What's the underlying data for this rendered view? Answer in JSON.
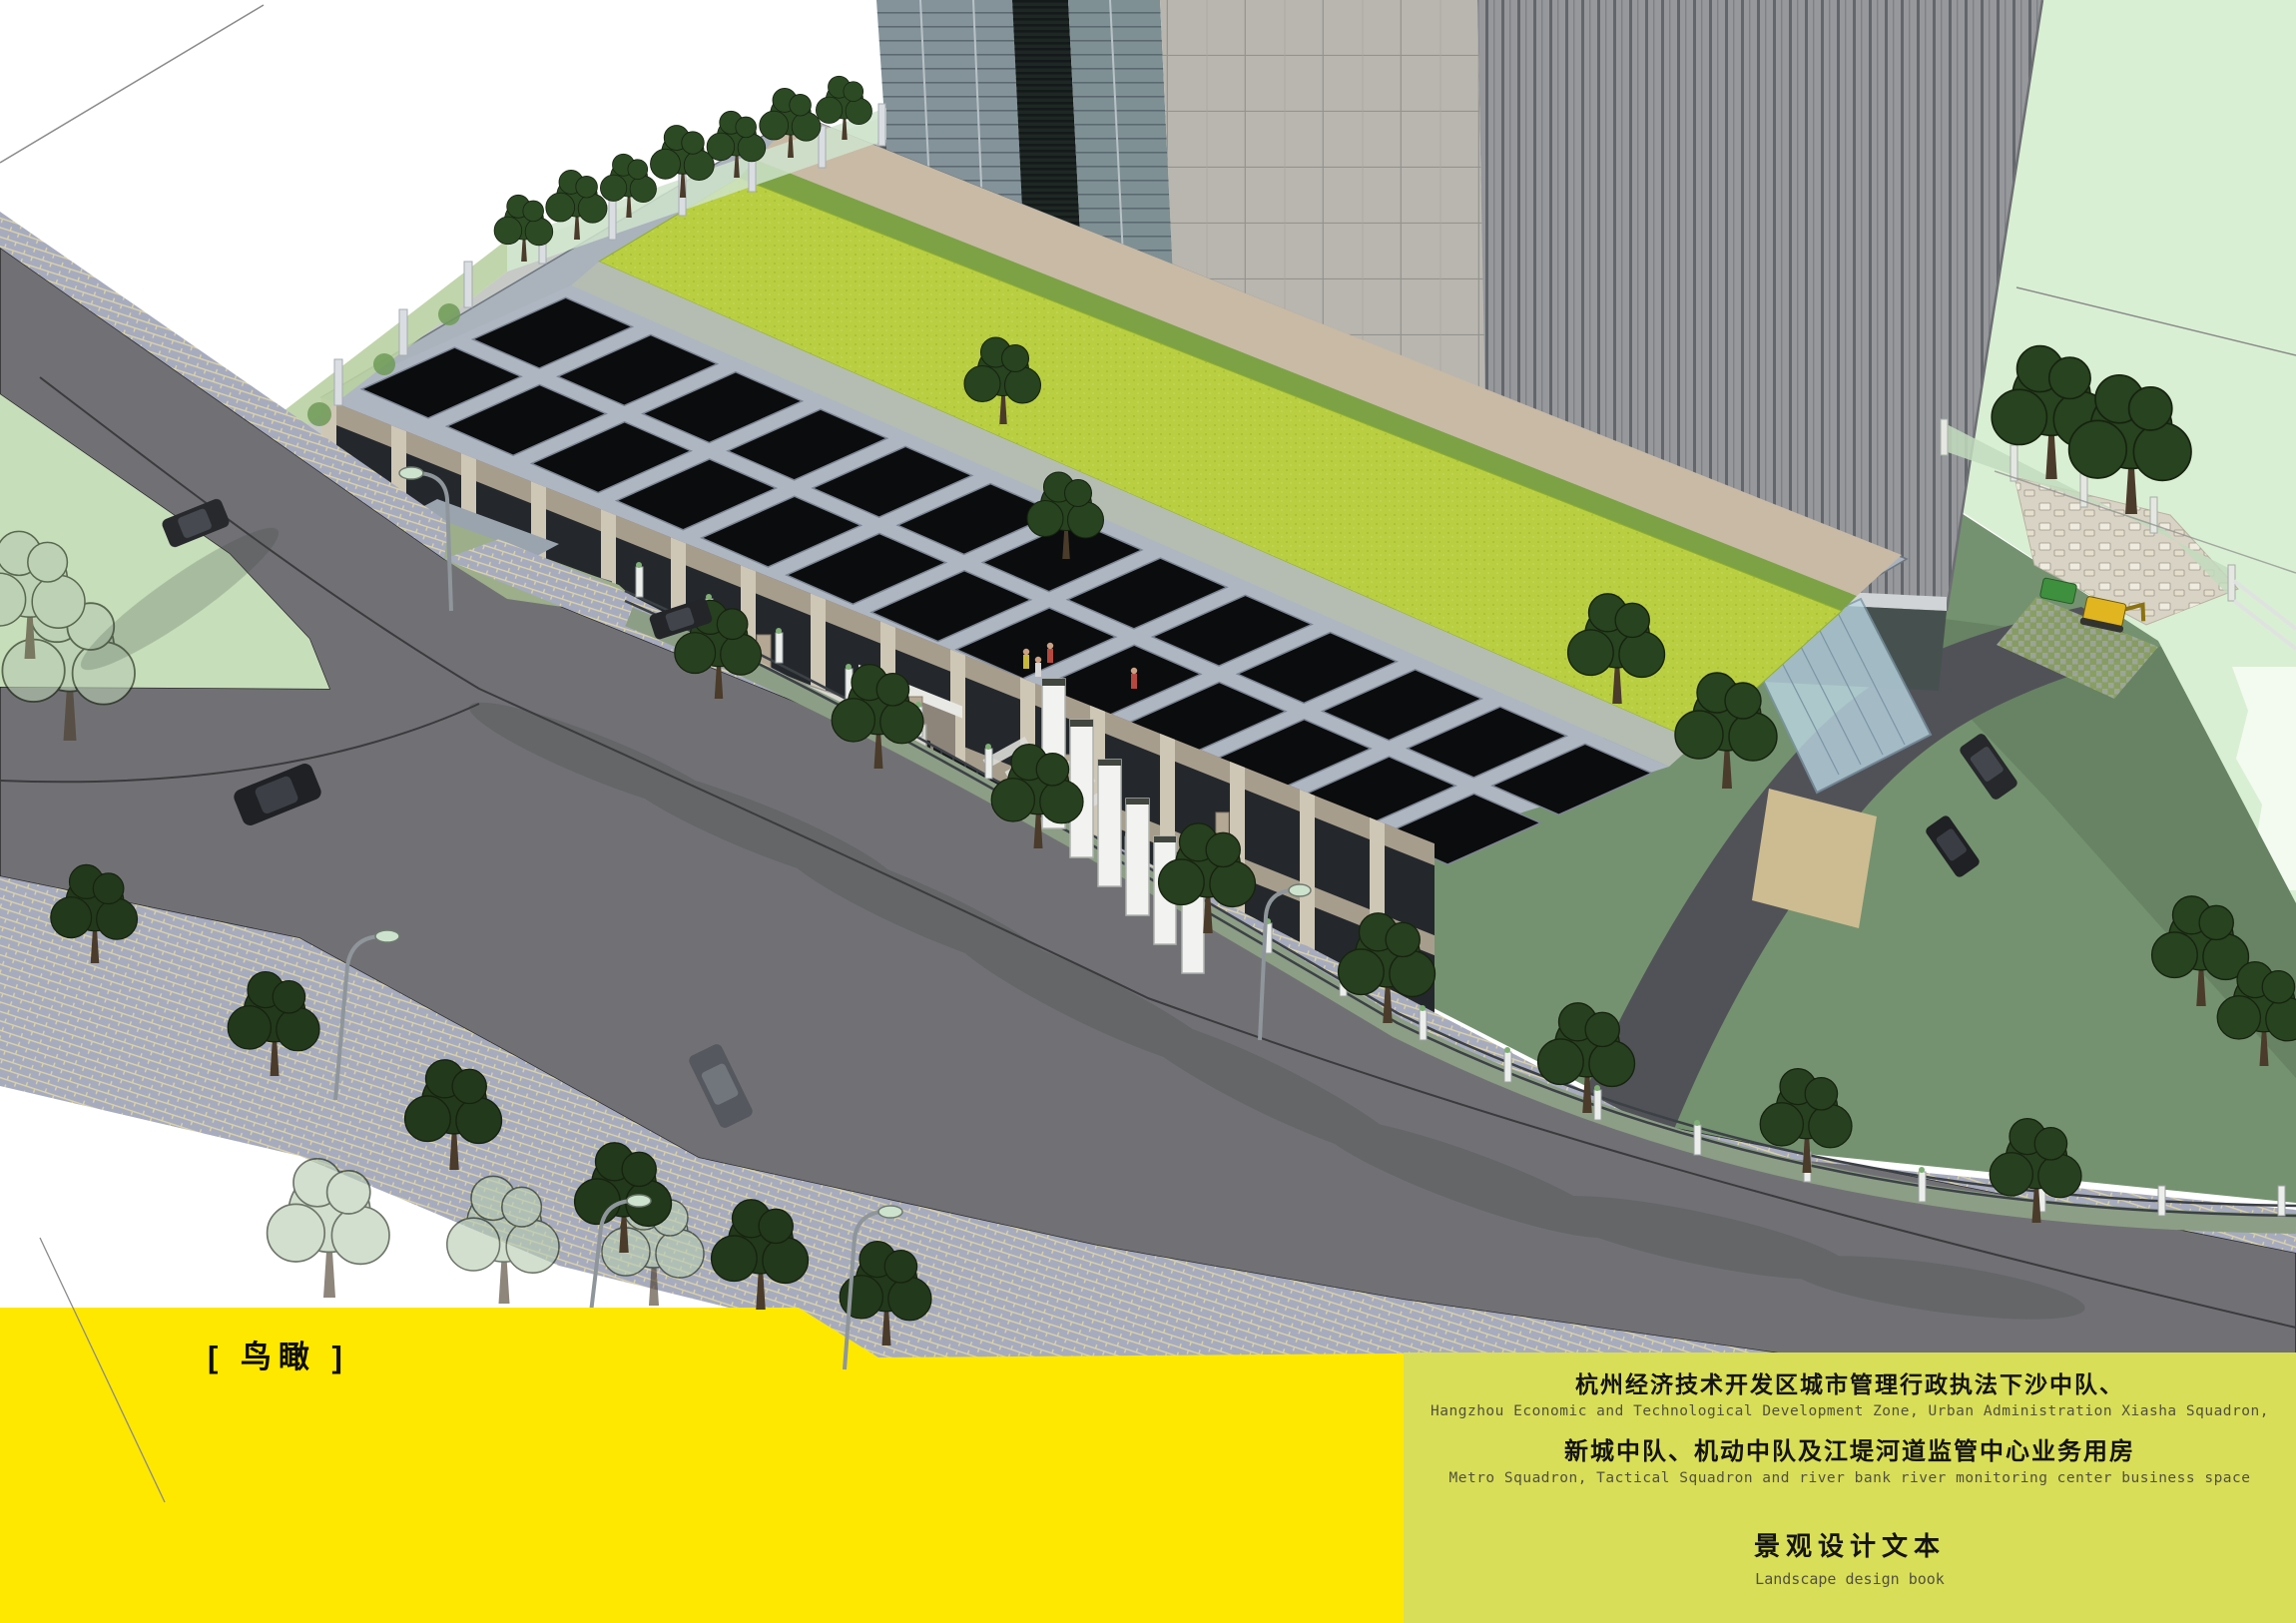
{
  "page_label": {
    "text": "[ 鸟瞰 ]"
  },
  "title_block": {
    "cn_line1": "杭州经济技术开发区城市管理行政执法下沙中队、",
    "en_line1": "Hangzhou Economic and Technological Development Zone, Urban Administration Xiasha Squadron,",
    "cn_line2": "新城中队、机动中队及江堤河道监管中心业务用房",
    "en_line2": "Metro Squadron, Tactical Squadron and river bank river monitoring center business space",
    "doc_cn": "景观设计文本",
    "doc_en": "Landscape design book"
  },
  "colors": {
    "band_left": "#FFE800",
    "band_right": "#D9DE58",
    "roof_grass": "#B9CE41",
    "pool_water": "#49B5C9",
    "flag_red": "#C32222",
    "road_gray": "#717175",
    "pale_field": "#D9EFD3",
    "sage_field": "#74926F"
  }
}
